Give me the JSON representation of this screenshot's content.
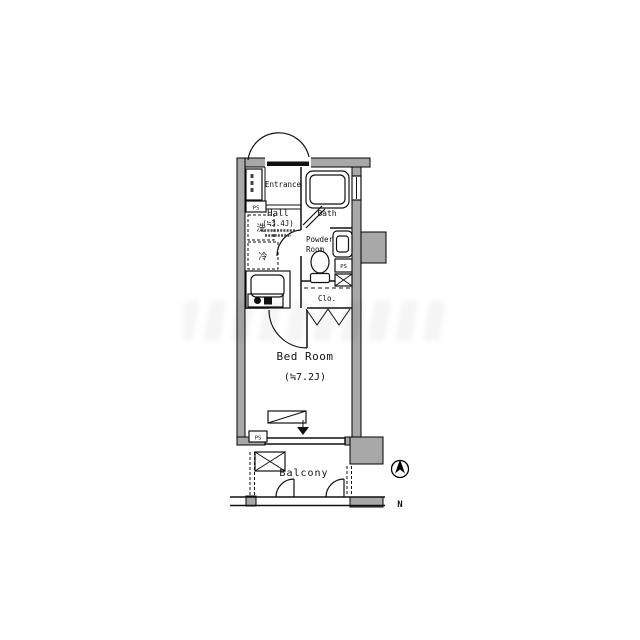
{
  "rooms": {
    "entrance": "Entrance",
    "hall": "Hall",
    "hall_size": "(≒3.4J)",
    "bath": "Bath",
    "powder_room_line1": "Powder",
    "powder_room_line2": "Room",
    "closet": "Clo.",
    "bedroom": "Bed Room",
    "bedroom_size": "(≒7.2J)",
    "balcony": "Balcony"
  },
  "fixtures": {
    "pipe_space": "PS",
    "washing_machine": "洗",
    "refrigerator": "冷"
  },
  "compass": {
    "north": "N"
  },
  "colors": {
    "wall": "#a8a8a8",
    "line": "#111111",
    "background": "#ffffff"
  }
}
